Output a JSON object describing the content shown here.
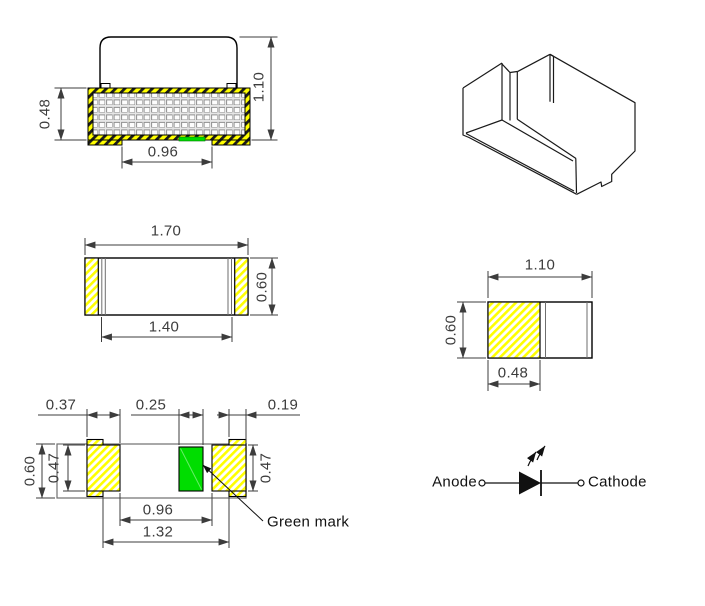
{
  "title": "SMD LED package dimensional drawing",
  "views": {
    "front": {
      "dim_terminal_height": "0.48",
      "dim_total_height": "1.10",
      "dim_pad_gap": "0.96"
    },
    "top": {
      "dim_length": "1.70",
      "dim_width": "0.60",
      "dim_body_length": "1.40"
    },
    "side": {
      "dim_length": "1.10",
      "dim_height": "0.60",
      "dim_terminal_width": "0.48"
    },
    "bottom": {
      "dim_pad_width": "0.37",
      "dim_mark_width": "0.25",
      "dim_wrap_width": "0.19",
      "dim_body_width": "0.60",
      "dim_pad_height_left": "0.47",
      "dim_pad_height_right": "0.47",
      "dim_pad_gap": "0.96",
      "dim_terminal_span": "1.32",
      "green_mark_label": "Green mark"
    },
    "symbol": {
      "anode_label": "Anode",
      "cathode_label": "Cathode"
    }
  },
  "colors": {
    "terminal_yellow": "#ffff00",
    "green_mark": "#00dd00",
    "stripe_dark": "#1a1a1a"
  }
}
